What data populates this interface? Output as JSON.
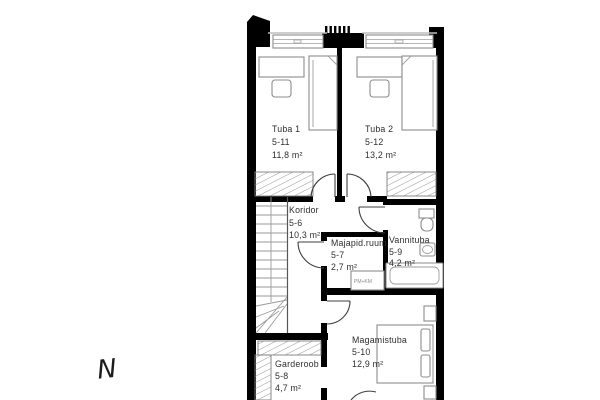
{
  "plan": {
    "title": "Upper floor plan",
    "compass_label": "N",
    "rooms": [
      {
        "name": "Tuba 1",
        "number": "5-11",
        "area": "11,8 m²"
      },
      {
        "name": "Tuba 2",
        "number": "5-12",
        "area": "13,2 m²"
      },
      {
        "name": "Koridor",
        "number": "5-6",
        "area": "10,3 m²"
      },
      {
        "name": "Majapid.ruum",
        "number": "5-7",
        "area": "2,7 m²"
      },
      {
        "name": "Vannituba",
        "number": "5-9",
        "area": "4,2 m²"
      },
      {
        "name": "Garderoob",
        "number": "5-8",
        "area": "4,7 m²"
      },
      {
        "name": "Magamistuba",
        "number": "5-10",
        "area": "12,9 m²"
      }
    ],
    "labels": {
      "appliances": "PM+KM"
    },
    "colors": {
      "wall": "#000000",
      "fixture_outline": "#8c8c8c",
      "hatch": "#8a8a8a",
      "text": "#2e2e2e",
      "window": "#9e9e9e",
      "background": "#ffffff"
    }
  }
}
